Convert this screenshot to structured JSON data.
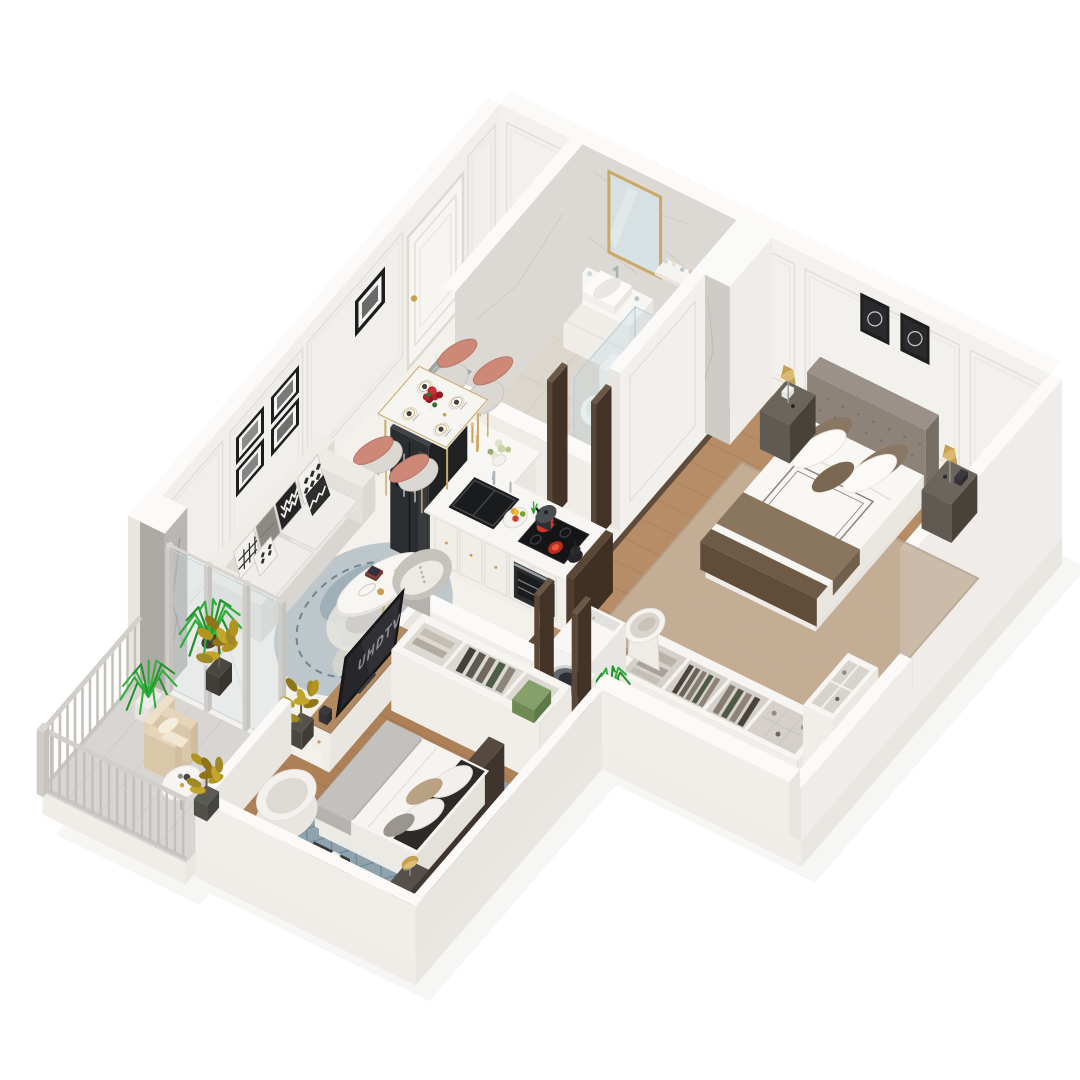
{
  "scene": {
    "type": "3d-floorplan-render",
    "view": "isometric cutaway apartment",
    "background": "#ffffff",
    "tv_label": "UHDTV"
  },
  "palette": {
    "wall": "#f3f1ed",
    "wall_top": "#fbfaf9",
    "wall_shade": "#e9e5e0",
    "wall_dark": "#e0dcd6",
    "marble_floor": "#f4f1ec",
    "marble_vein": "#e3dfd8",
    "marble_wall": "#dcd9d5",
    "bath_floor": "#ddd6cd",
    "wood_master": "#b68d66",
    "wood_master_line": "#a67c57",
    "wood_bed2": "#ad8058",
    "wood_bed2_line": "#9a6f4b",
    "balcony_tile": "#d8d6d2",
    "gold": "#c9a050",
    "gold_rim": "#c9a964",
    "dark_wood": "#5a4738",
    "sofa": "#e9e6e2",
    "rug_living": "#bcc6cb",
    "rug_living_blotch": "#93a7b1",
    "rug_bed2": "#8fa3ae",
    "rug_bed2_line": "#6f8694",
    "rug_master": "#c6b39e",
    "salmon_chair": "#cd8878",
    "fridge": "#2b2e31",
    "tv_black": "#1b1b1d",
    "tv_screen": "#26262b",
    "tv_text": "#8f8f95",
    "burner_red": "#d6352a",
    "burner_hot": "#ff6a4f",
    "plant_green": "#2fae39",
    "plant_green_dark": "#23902d",
    "plant_olive": "#a08a28",
    "plant_olive_dark": "#8f7418",
    "bed_brown": "#8a765f",
    "headboard_gray": "#8d8379",
    "headboard_dark": "#4a3f36",
    "green_box": "#7f9a66",
    "chrome": "#aab2b6",
    "glass": "#c6dce4"
  },
  "rooms": [
    {
      "id": "living-dining",
      "name": "Living & Dining Area",
      "floor": "white marble",
      "furniture": [
        "gray fabric sofa with black-and-white patterned pillows",
        "oval white coffee table with gold legs",
        "round blue-gray area rug",
        "gray pouf with knit throw",
        "TV console with flat-screen TV",
        "marble dining table with gold legs",
        "four upholstered dining chairs (salmon and gray)",
        "red rose centerpiece",
        "2x2 gallery wall of black-framed photos",
        "single black-framed photo",
        "entry door with patterned doormat",
        "gray marble accent pier",
        "glass partition to balcony"
      ]
    },
    {
      "id": "kitchen",
      "name": "Open Kitchen",
      "floor": "white marble",
      "furniture": [
        "black double-door refrigerator",
        "white island counter with black double sink",
        "induction cooktop with glowing red burners",
        "pot and black kettle",
        "built-in oven",
        "fruit bowl",
        "white console dresser with books, candlesticks and flowers"
      ]
    },
    {
      "id": "bathroom",
      "name": "Bathroom",
      "floor": "beige marble tile",
      "furniture": [
        "white vanity with basin and chrome faucet",
        "gold-framed mirror",
        "toiletry shelf",
        "toilet",
        "glass walk-in shower with chrome column",
        "round accent rug",
        "service shaft"
      ]
    },
    {
      "id": "master-bedroom",
      "name": "Master Bedroom",
      "floor": "wood planks",
      "furniture": [
        "king bed with tufted gray headboard",
        "white duvet with brown throw",
        "two dark nightstands",
        "two gold table lamps",
        "two black-framed artworks",
        "open closet with hanging clothes and cubbies",
        "white laundry basket",
        "washing machine",
        "potted plant in niche"
      ]
    },
    {
      "id": "second-bedroom",
      "name": "Second Bedroom",
      "floor": "wood planks",
      "furniture": [
        "double bed with dark wood headboard",
        "blue diamond-pattern rug",
        "white wardrobe with open hanging section",
        "green storage box",
        "round white armchair",
        "nightstand with gold lamp",
        "small dark vanity table"
      ]
    },
    {
      "id": "balcony",
      "name": "Balcony",
      "floor": "gray tile",
      "furniture": [
        "gray slat railing",
        "beige armchair",
        "round white side table",
        "green fern in pot",
        "olive potted plants"
      ]
    }
  ]
}
